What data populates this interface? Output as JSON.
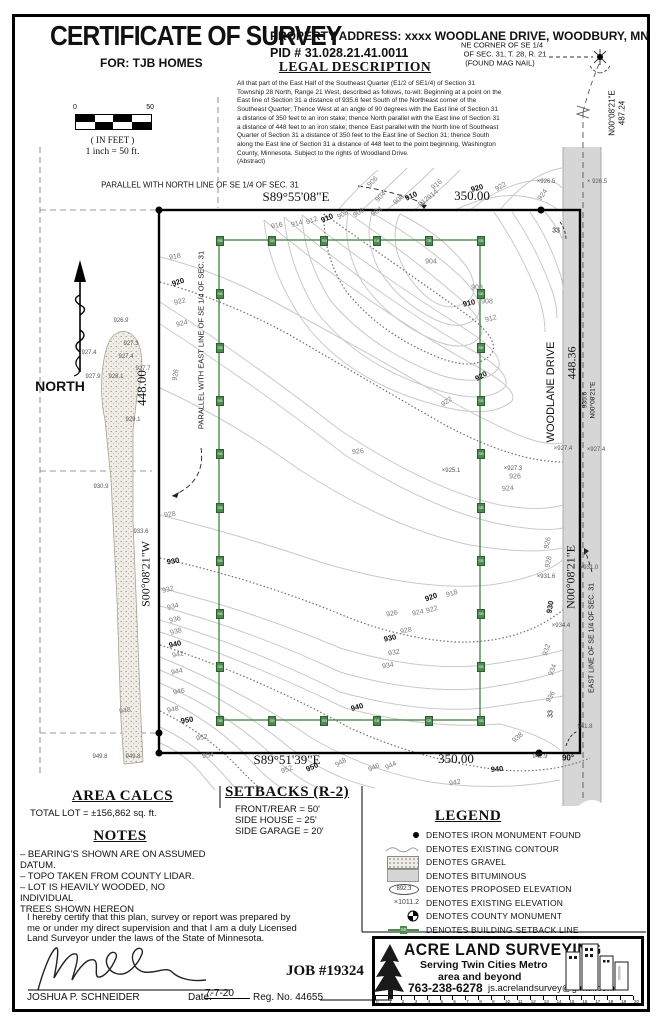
{
  "header": {
    "title": "CERTIFICATE OF SURVEY",
    "for_line": "FOR: TJB HOMES",
    "property_address": "PROPERTY ADDRESS:  xxxx WOODLANE DRIVE, WOODBURY, MN",
    "pid": "PID # 31.028.21.41.0011"
  },
  "legal": {
    "heading": "LEGAL DESCRIPTION",
    "body": "All that part of the East Half of the Southeast Quarter (E1/2 of SE1/4) of Section 31\nTownship 28 North, Range 21 West, described as follows, to-wit: Beginning at a point on the\nEast line  of Section 31 a distance of 935.6 feet South of the Northeast corner of the\nSoutheast Quarter; Thence  West at an angle  of 90 degrees with the East line of Section 31\na distance of 350  feet to an iron stake; thence North parallel with the East line  of Section 31\na distance of 448  feet to an iron stake; thence East parallel with the North line  of Southeast\nQuarter of Section 31 a distance of 350  feet to the East line  of Section 31; thence South\nalong the East line  of Section 31 a distance of 448  feet to the point beginning, Washington\nCounty, Minnesota. Subject to the rights of Woodland Drive.\n(Abstract)"
  },
  "scale_bar": {
    "left": "0",
    "right": "50",
    "units": "( IN FEET )",
    "ratio": "1 inch  =  50 ft."
  },
  "map": {
    "accent_green": "#4c8a50",
    "road_gray": "#d6d6d6",
    "labels": [
      {
        "t": "NE CORNER OF SE 1/4",
        "x": 502,
        "y": 45,
        "s": 7.5
      },
      {
        "t": "OF SEC. 31, T. 28, R. 21",
        "x": 505,
        "y": 54,
        "s": 7.5
      },
      {
        "t": "(FOUND MAG NAIL)",
        "x": 500,
        "y": 63,
        "s": 7.5
      },
      {
        "t": "PARALLEL WITH NORTH LINE OF SE 1/4 OF SEC. 31",
        "x": 200,
        "y": 185,
        "s": 8
      },
      {
        "t": "S89°55'08\"E",
        "x": 296,
        "y": 197,
        "s": 13,
        "f": 1
      },
      {
        "t": "350.00",
        "x": 472,
        "y": 196,
        "s": 13,
        "f": 1
      },
      {
        "t": "448.00",
        "x": 142,
        "y": 388,
        "s": 13,
        "f": 1,
        "r": -90
      },
      {
        "t": "S00°08'21\"W",
        "x": 146,
        "y": 574,
        "s": 12,
        "f": 1,
        "r": -90
      },
      {
        "t": "PARALLEL WITH EAST LINE OF SE 1/4 OF SEC. 31",
        "x": 201,
        "y": 340,
        "s": 7.5,
        "r": -90
      },
      {
        "t": "S89°51'39\"E",
        "x": 287,
        "y": 760,
        "s": 13,
        "f": 1
      },
      {
        "t": "350.00",
        "x": 456,
        "y": 759,
        "s": 13,
        "f": 1
      },
      {
        "t": "WOODLANE DRIVE",
        "x": 551,
        "y": 392,
        "s": 11,
        "r": -90
      },
      {
        "t": "448.36",
        "x": 572,
        "y": 363,
        "s": 12,
        "f": 1,
        "r": -90
      },
      {
        "t": "935.6",
        "x": 585,
        "y": 400,
        "s": 6.5,
        "r": -90
      },
      {
        "t": "N00°08'21\"E",
        "x": 593,
        "y": 400,
        "s": 6.5,
        "r": -90
      },
      {
        "t": "N00°08'21\"E",
        "x": 571,
        "y": 577,
        "s": 12,
        "f": 1,
        "r": -90
      },
      {
        "t": "EAST LINE OF SE 1/4 OF SEC. 31",
        "x": 592,
        "y": 638,
        "s": 7,
        "r": -90
      },
      {
        "t": "N00°08'21\"E",
        "x": 612,
        "y": 113,
        "s": 8,
        "r": -90
      },
      {
        "t": "487.24",
        "x": 622,
        "y": 113,
        "s": 8,
        "r": -90
      },
      {
        "t": "90°",
        "x": 568,
        "y": 758,
        "s": 8,
        "w": 1
      },
      {
        "t": "33",
        "x": 556,
        "y": 231,
        "s": 7
      },
      {
        "t": "33",
        "x": 551,
        "y": 714,
        "s": 7,
        "r": -90
      },
      {
        "t": "NORTH",
        "x": 60,
        "y": 386,
        "s": 14,
        "w": 1
      }
    ],
    "contour_labels": [
      [
        "906",
        373,
        182,
        -45
      ],
      [
        "904",
        381,
        197,
        -45
      ],
      [
        "908",
        399,
        200,
        -40
      ],
      [
        "910",
        411,
        196,
        -25,
        1
      ],
      [
        "912",
        424,
        202,
        -40
      ],
      [
        "914",
        433,
        195,
        -40
      ],
      [
        "916",
        437,
        185,
        -40
      ],
      [
        "920",
        477,
        188,
        -15,
        1
      ],
      [
        "922",
        501,
        187,
        -30
      ],
      [
        "924",
        543,
        195,
        -55
      ],
      [
        "916",
        277,
        226,
        -10
      ],
      [
        "914",
        297,
        224,
        -15
      ],
      [
        "912",
        312,
        221,
        -20
      ],
      [
        "910",
        327,
        218,
        -25,
        1
      ],
      [
        "908",
        343,
        215,
        -30
      ],
      [
        "906",
        359,
        213,
        -33
      ],
      [
        "904",
        377,
        212,
        -36
      ],
      [
        "904",
        431,
        262,
        0
      ],
      [
        "908",
        477,
        288,
        0
      ],
      [
        "910",
        469,
        303,
        -12,
        1
      ],
      [
        "908",
        487,
        302,
        0
      ],
      [
        "912",
        491,
        319,
        -15
      ],
      [
        "918",
        175,
        257,
        -10
      ],
      [
        "920",
        178,
        282,
        -18,
        1
      ],
      [
        "922",
        180,
        302,
        -14
      ],
      [
        "924",
        182,
        324,
        -13
      ],
      [
        "926",
        176,
        375,
        -80
      ],
      [
        "922",
        447,
        402,
        -35
      ],
      [
        "926",
        358,
        452,
        -5
      ],
      [
        "920",
        481,
        376,
        -30,
        1
      ],
      [
        "926",
        515,
        477,
        0
      ],
      [
        "924",
        508,
        489,
        -5
      ],
      [
        "926",
        548,
        543,
        -78
      ],
      [
        "928",
        549,
        562,
        -78
      ],
      [
        "930",
        550,
        607,
        -80,
        1
      ],
      [
        "932",
        547,
        650,
        -72
      ],
      [
        "934",
        553,
        670,
        -70
      ],
      [
        "936",
        551,
        697,
        -60
      ],
      [
        "938",
        518,
        738,
        -40
      ],
      [
        "918",
        452,
        594,
        -16
      ],
      [
        "920",
        431,
        597,
        -20,
        1
      ],
      [
        "922",
        432,
        610,
        -16
      ],
      [
        "924",
        418,
        613,
        -12
      ],
      [
        "926",
        392,
        614,
        -10
      ],
      [
        "928",
        406,
        631,
        -12
      ],
      [
        "930",
        390,
        638,
        -12,
        1
      ],
      [
        "932",
        394,
        653,
        -10
      ],
      [
        "934",
        388,
        666,
        -10
      ],
      [
        "940",
        357,
        707,
        -16,
        1
      ],
      [
        "928",
        170,
        515,
        -8
      ],
      [
        "930",
        173,
        561,
        -10,
        1
      ],
      [
        "932",
        168,
        590,
        -14
      ],
      [
        "934",
        173,
        607,
        -14
      ],
      [
        "936",
        175,
        620,
        -14
      ],
      [
        "938",
        176,
        632,
        -14
      ],
      [
        "940",
        175,
        644,
        -12,
        1
      ],
      [
        "942",
        178,
        655,
        -12
      ],
      [
        "944",
        177,
        672,
        -12
      ],
      [
        "946",
        179,
        692,
        -12
      ],
      [
        "948",
        173,
        710,
        -12
      ],
      [
        "950",
        187,
        720,
        -10,
        1
      ],
      [
        "952",
        202,
        738,
        -10
      ],
      [
        "954",
        208,
        756,
        -8
      ],
      [
        "950",
        312,
        767,
        -25,
        1
      ],
      [
        "952",
        287,
        770,
        -20
      ],
      [
        "948",
        341,
        763,
        -30
      ],
      [
        "946",
        374,
        768,
        -25
      ],
      [
        "944",
        391,
        766,
        -25
      ],
      [
        "942",
        455,
        783,
        -10
      ],
      [
        "940",
        497,
        769,
        -5,
        1
      ],
      [
        "948",
        125,
        711,
        -10
      ]
    ],
    "spot_elevations": [
      [
        "×926.5",
        546,
        182
      ],
      [
        "× 926.5",
        597,
        182
      ],
      [
        "×927.4",
        563,
        449
      ],
      [
        "×927.4",
        596,
        450
      ],
      [
        "×931.6",
        546,
        577
      ],
      [
        "×931.0",
        589,
        568
      ],
      [
        "×934.4",
        561,
        626
      ],
      [
        "941.8",
        585,
        727
      ],
      [
        "942.9",
        540,
        757
      ],
      [
        "949.8",
        100,
        757
      ],
      [
        "949.8",
        133,
        757
      ],
      [
        "926.9",
        121,
        321
      ],
      [
        "927.3",
        131,
        344
      ],
      [
        "927.4",
        89,
        353
      ],
      [
        "927.4",
        126,
        357
      ],
      [
        "927.7",
        143,
        369
      ],
      [
        "927.9",
        93,
        377
      ],
      [
        "928.1",
        116,
        377
      ],
      [
        "929.1",
        133,
        420
      ],
      [
        "930.9",
        101,
        487
      ],
      [
        "933.6",
        141,
        532
      ],
      [
        "×925.1",
        451,
        471
      ],
      [
        "×927.3",
        513,
        469
      ]
    ]
  },
  "panels": {
    "area_calcs": {
      "heading": "AREA CALCS",
      "total": "TOTAL LOT  =  ±156,862  sq.  ft."
    },
    "notes": {
      "heading": "NOTES",
      "items": [
        "–  BEARING'S SHOWN ARE ON ASSUMED DATUM.",
        "–  TOPO TAKEN FROM COUNTY LIDAR.",
        "–  LOT IS HEAVILY WOODED, NO INDIVIDUAL\nTREES SHOWN HEREON"
      ]
    },
    "setbacks": {
      "heading": "SETBACKS (R-2)",
      "items": [
        "FRONT/REAR  =  50'",
        "SIDE HOUSE  =  25'",
        "SIDE GARAGE  =  20'"
      ]
    },
    "legend": {
      "heading": "LEGEND",
      "proposed_value": "892.3",
      "existing_value": "×1011.2",
      "sb_label": "SB",
      "items": [
        {
          "sym": "monument",
          "text": "DENOTES IRON MONUMENT FOUND"
        },
        {
          "sym": "contour",
          "text": "DENOTES EXISTING CONTOUR"
        },
        {
          "sym": "gravel",
          "text": "DENOTES GRAVEL"
        },
        {
          "sym": "bituminous",
          "text": "DENOTES BITUMINOUS"
        },
        {
          "sym": "proposed",
          "text": "DENOTES PROPOSED ELEVATION"
        },
        {
          "sym": "existing",
          "text": "DENOTES EXISTING ELEVATION"
        },
        {
          "sym": "county",
          "text": "DENOTES COUNTY MONUMENT"
        },
        {
          "sym": "setback",
          "text": "DENOTES BUILDING SETBACK LINE"
        }
      ]
    }
  },
  "certification": {
    "text": "I hereby certify that this plan, survey or report was prepared by\nme or under my direct supervision and that I am a duly Licensed\nLand Surveyor under the laws of the State of Minnesota.",
    "name": "JOSHUA P. SCHNEIDER",
    "date_label": "Date:",
    "date_value": "7-7-20",
    "reg": "Reg.  No.  44655",
    "job": "JOB #19324"
  },
  "firm": {
    "name": "ACRE LAND SURVEYING",
    "tag1": "Serving Twin Cities Metro",
    "tag2": "area and beyond",
    "phone": "763-238-6278",
    "email": "js.acrelandsurvey@gmail.com",
    "ruler_range": [
      0,
      20
    ]
  }
}
